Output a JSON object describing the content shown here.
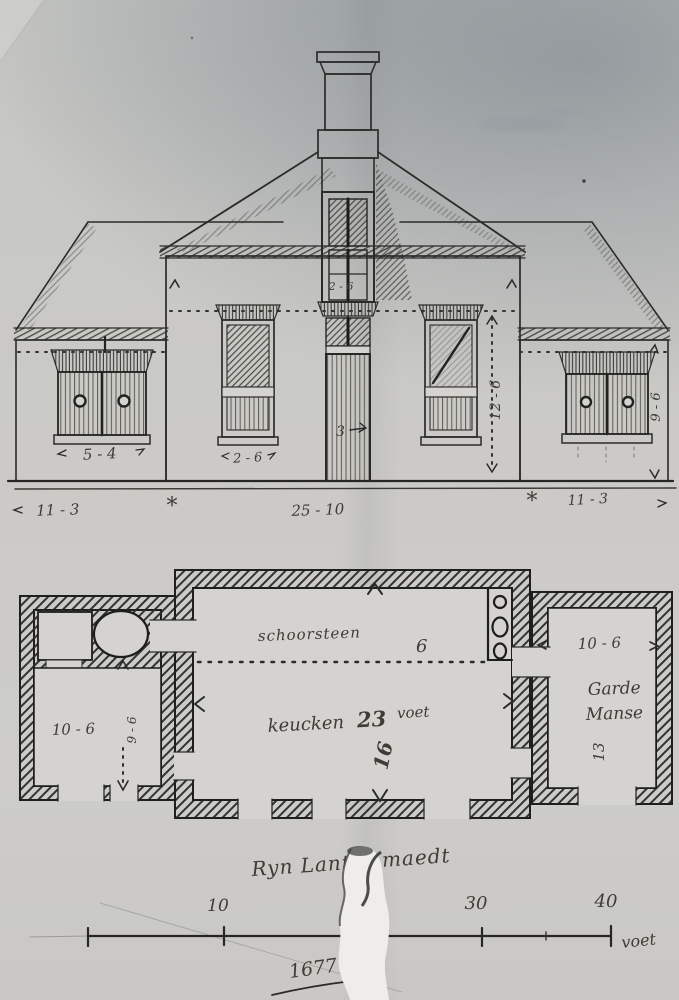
{
  "photo": {
    "paper_color": "#d4d3cf",
    "ink_color": "#2b2b28"
  },
  "elevation": {
    "dims": {
      "left_wing_window_width": "5 - 4",
      "main_window_width": "2 - 6",
      "gable_window_width": "2 - 6",
      "door_width": "3",
      "facade_height": "12 - 6",
      "wing_height": "9 - 6",
      "ground_left": "11 - 3",
      "ground_center": "25 - 10",
      "ground_right": "11 - 3",
      "separator": "*"
    }
  },
  "floor_plan": {
    "hearth_label": "schoorsteen",
    "hearth_depth": "6",
    "kitchen_name": "keucken",
    "kitchen_width": "23",
    "kitchen_unit": "voet",
    "kitchen_depth": "16",
    "left_room_width": "10 - 6",
    "left_room_depth": "9 - 6",
    "pantry_width": "10 - 6",
    "pantry_name_line1": "Garde",
    "pantry_name_line2": "Manse",
    "pantry_depth": "13"
  },
  "scale_bar": {
    "title": "Ryn Lantse maedt",
    "ticks": [
      "10",
      "30",
      "40"
    ],
    "unit": "voet",
    "date": "1677"
  }
}
